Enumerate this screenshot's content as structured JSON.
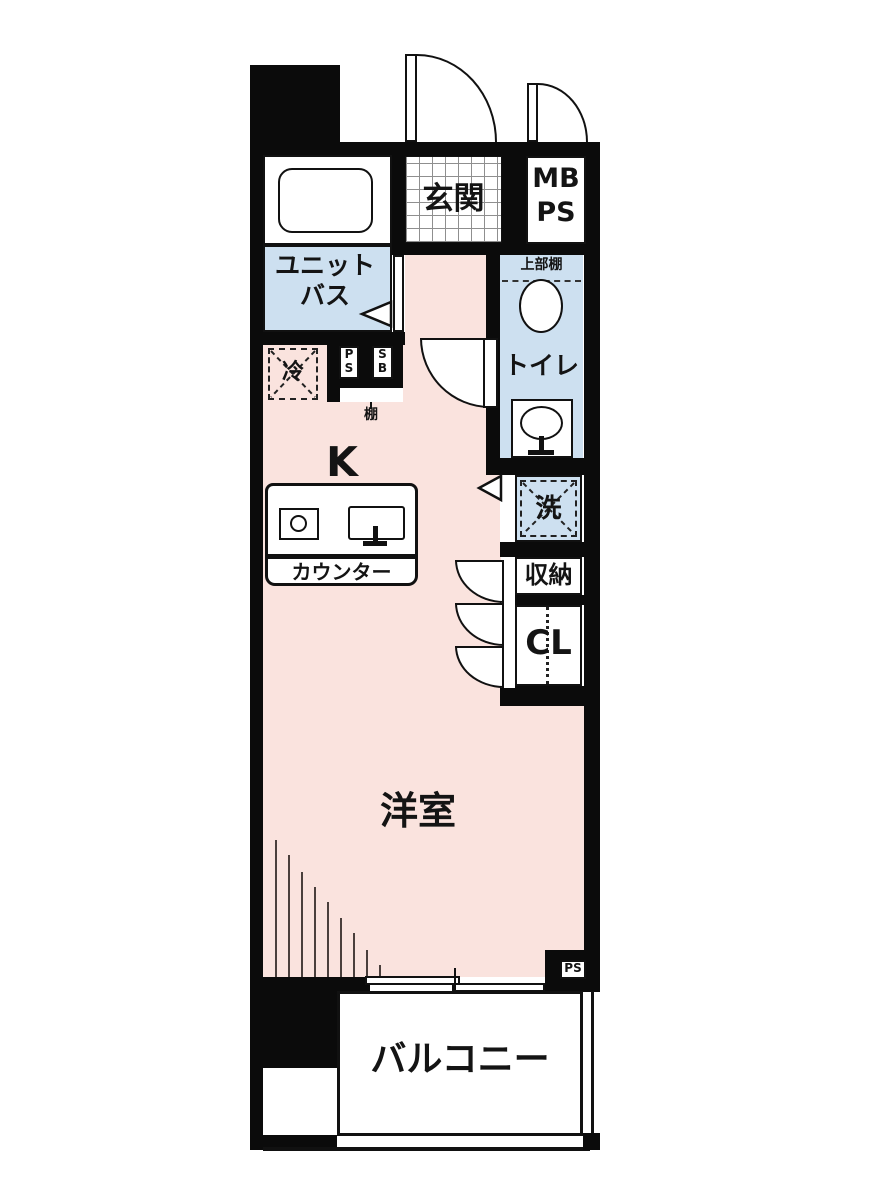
{
  "plan": {
    "colors": {
      "floor_pink": "#fae3de",
      "water_blue": "#cde0f0",
      "wall_black": "#0b0b0b",
      "tile_grid_gray": "#8f8f8f"
    },
    "labels": {
      "entrance": "玄関",
      "meter_box_line1": "MB",
      "meter_box_line2": "PS",
      "unit_bath_line1": "ユニット",
      "unit_bath_line2": "バス",
      "upper_shelf": "上部棚",
      "toilet": "トイレ",
      "fridge": "冷",
      "pipe_shaft_p": "P",
      "pipe_shaft_s": "S",
      "shutter_box_s": "S",
      "shutter_box_b": "B",
      "shelf": "棚",
      "kitchen": "K",
      "counter": "カウンター",
      "washer": "洗",
      "storage": "収納",
      "closet": "CL",
      "western_room": "洋室",
      "balcony": "バルコニー",
      "pipe_space_bottom": "PS"
    }
  }
}
